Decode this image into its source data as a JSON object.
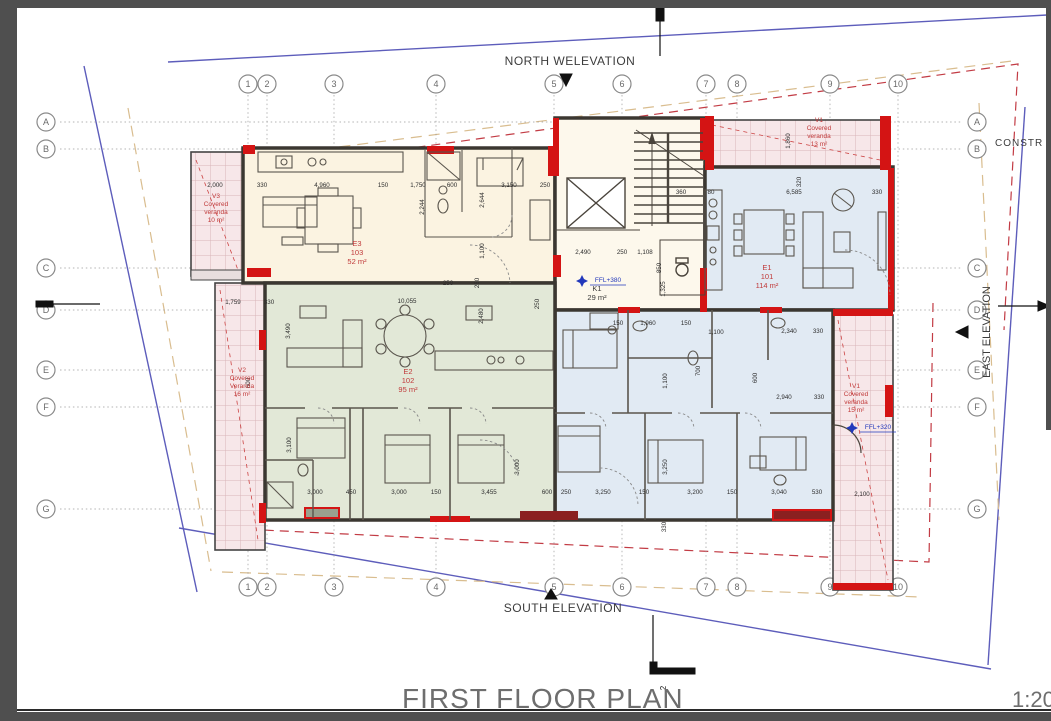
{
  "sheet": {
    "title": "FIRST FLOOR PLAN",
    "scale": "1:20",
    "section_marker": "2"
  },
  "compass": {
    "north": "NORTH WELEVATION",
    "south": "SOUTH ELEVATION",
    "east": "EAST ELEVATION",
    "constr": "CONSTR"
  },
  "watermark": {
    "line1": "AMERICANOS",
    "line2": "REAL ESTATE"
  },
  "grid": {
    "columns": [
      "1",
      "2",
      "3",
      "4",
      "5",
      "6",
      "7",
      "8",
      "9",
      "10"
    ],
    "rows": [
      "A",
      "B",
      "C",
      "D",
      "E",
      "F",
      "G"
    ]
  },
  "rooms": [
    {
      "lines": [
        "E3",
        "103",
        "52 m²"
      ],
      "x": 357,
      "y": 246,
      "color": "#c03a3a"
    },
    {
      "lines": [
        "E2",
        "102",
        "95 m²"
      ],
      "x": 408,
      "y": 374,
      "color": "#c03a3a"
    },
    {
      "lines": [
        "E1",
        "101",
        "114 m²"
      ],
      "x": 767,
      "y": 270,
      "color": "#c03a3a"
    },
    {
      "lines": [
        "K1",
        "29 m²"
      ],
      "x": 597,
      "y": 291,
      "color": "#3a3a3a"
    }
  ],
  "verandas": [
    {
      "lines": [
        "V3",
        "Covered",
        "veranda",
        "10 m²"
      ],
      "x": 216,
      "y": 198
    },
    {
      "lines": [
        "V2",
        "Covered",
        "Veranda",
        "16 m²"
      ],
      "x": 242,
      "y": 372
    },
    {
      "lines": [
        "V1",
        "Covered",
        "veranda",
        "13 m²"
      ],
      "x": 819,
      "y": 122
    },
    {
      "lines": [
        "V1",
        "Covered",
        "veranda",
        "15 m²"
      ],
      "x": 856,
      "y": 388
    }
  ],
  "levels": [
    {
      "label": "FFL+380",
      "x": 592,
      "y": 284
    },
    {
      "label": "FFL+320",
      "x": 862,
      "y": 431
    }
  ],
  "dimensions": [
    [
      "2,000",
      215,
      187,
      0
    ],
    [
      "330",
      262,
      187,
      0
    ],
    [
      "4,960",
      322,
      187,
      0
    ],
    [
      "150",
      383,
      187,
      0
    ],
    [
      "1,750",
      418,
      187,
      0
    ],
    [
      "600",
      452,
      187,
      0
    ],
    [
      "3,150",
      509,
      187,
      0
    ],
    [
      "250",
      545,
      187,
      0
    ],
    [
      "360",
      681,
      194,
      0
    ],
    [
      "80",
      711,
      194,
      0
    ],
    [
      "6,585",
      794,
      194,
      0
    ],
    [
      "330",
      877,
      194,
      0
    ],
    [
      "1,860",
      790,
      141,
      1
    ],
    [
      "320",
      801,
      182,
      1
    ],
    [
      "2,244",
      424,
      207,
      1
    ],
    [
      "2,644",
      484,
      200,
      1
    ],
    [
      "1,100",
      484,
      251,
      1
    ],
    [
      "250",
      479,
      283,
      1
    ],
    [
      "1,759",
      233,
      304,
      0
    ],
    [
      "330",
      269,
      304,
      0
    ],
    [
      "10,055",
      407,
      303,
      0
    ],
    [
      "250",
      448,
      285,
      0
    ],
    [
      "2,480",
      483,
      316,
      1
    ],
    [
      "250",
      539,
      304,
      1
    ],
    [
      "3,490",
      290,
      331,
      1
    ],
    [
      "600",
      250,
      383,
      1
    ],
    [
      "3,100",
      291,
      445,
      1
    ],
    [
      "2,490",
      583,
      254,
      0
    ],
    [
      "250",
      622,
      254,
      0
    ],
    [
      "1,108",
      645,
      254,
      0
    ],
    [
      "850",
      661,
      268,
      1
    ],
    [
      "1,325",
      665,
      289,
      1
    ],
    [
      "150",
      618,
      325,
      0
    ],
    [
      "1,960",
      648,
      325,
      0
    ],
    [
      "150",
      686,
      325,
      0
    ],
    [
      "1,100",
      716,
      334,
      0
    ],
    [
      "2,340",
      789,
      333,
      0
    ],
    [
      "330",
      818,
      333,
      0
    ],
    [
      "1,100",
      667,
      381,
      1
    ],
    [
      "600",
      757,
      378,
      1
    ],
    [
      "700",
      700,
      371,
      1
    ],
    [
      "2,940",
      784,
      399,
      0
    ],
    [
      "330",
      819,
      399,
      0
    ],
    [
      "3,000",
      315,
      494,
      0
    ],
    [
      "450",
      351,
      494,
      0
    ],
    [
      "3,000",
      399,
      494,
      0
    ],
    [
      "150",
      436,
      494,
      0
    ],
    [
      "3,455",
      489,
      494,
      0
    ],
    [
      "600",
      547,
      494,
      0
    ],
    [
      "250",
      566,
      494,
      0
    ],
    [
      "3,250",
      603,
      494,
      0
    ],
    [
      "150",
      644,
      494,
      0
    ],
    [
      "3,200",
      695,
      494,
      0
    ],
    [
      "150",
      732,
      494,
      0
    ],
    [
      "3,040",
      779,
      494,
      0
    ],
    [
      "530",
      817,
      494,
      0
    ],
    [
      "2,100",
      862,
      496,
      0
    ],
    [
      "3,250",
      667,
      467,
      1
    ],
    [
      "330",
      666,
      527,
      1
    ],
    [
      "3,000",
      519,
      467,
      1
    ]
  ]
}
